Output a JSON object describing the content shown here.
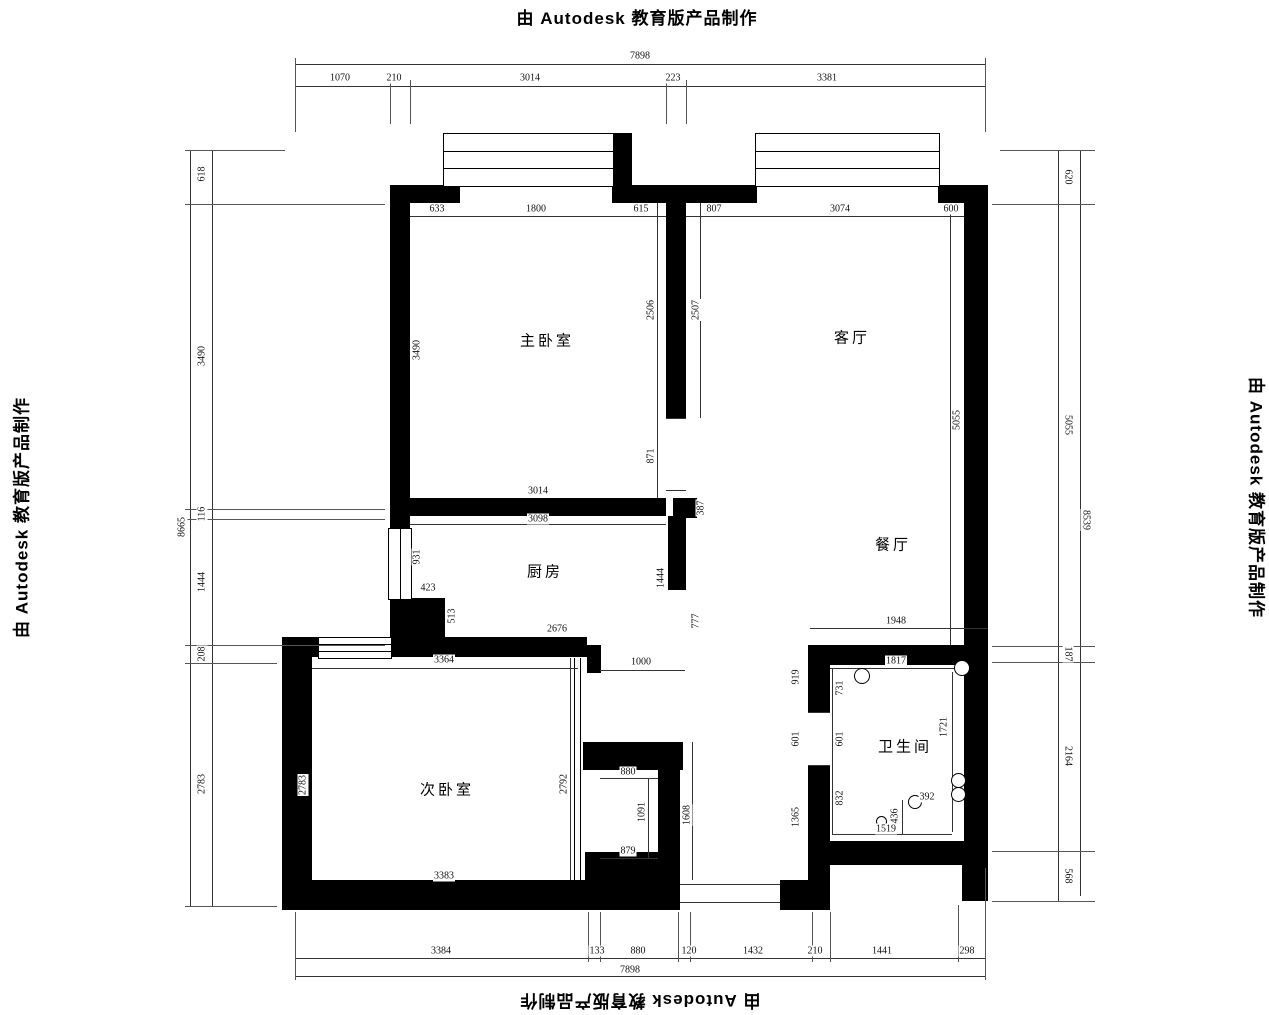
{
  "banner": "由 Autodesk 教育版产品制作",
  "rooms": {
    "master_bedroom": "主卧室",
    "living_room": "客厅",
    "kitchen": "厨房",
    "dining_room": "餐厅",
    "second_bedroom": "次卧室",
    "bathroom": "卫生间"
  },
  "dims": {
    "top": {
      "total": "7898",
      "segs": [
        "1070",
        "210",
        "3014",
        "223",
        "3381"
      ]
    },
    "bottom": {
      "total": "7898",
      "segs": [
        "3384",
        "133",
        "880",
        "120",
        "1432",
        "210",
        "1441",
        "298"
      ]
    },
    "left": {
      "total": "8665",
      "segs": [
        "618",
        "3490",
        "116",
        "1444",
        "208",
        "2783"
      ]
    },
    "right": {
      "total": "8539",
      "segs": [
        "620",
        "5055",
        "187",
        "2164",
        "568"
      ]
    },
    "interior": {
      "mb_top": [
        "633",
        "1800",
        "615"
      ],
      "lr_top": [
        "807",
        "3074",
        "600"
      ],
      "mb_left": "3490",
      "mb_door_right": "2506",
      "lr_wall_right": "2507",
      "mb_door": "871",
      "mb_bottom": "3014",
      "kitchen_top": "3098",
      "wall_seg": "387",
      "kitchen_win": "931",
      "step_a": "423",
      "step_b": "513",
      "kitchen_bottom": "2676",
      "kitchen_right": "1444",
      "kitchen_door": "777",
      "lr_height": "5055",
      "dining_bottom": "1948",
      "sb_top": "3364",
      "sb_left": "2783",
      "sb_right": "2792",
      "sb_bottom": "3383",
      "hall": "1000",
      "closet_top": "880",
      "closet_depth": "1091",
      "closet_right": "1608",
      "closet_bottom": "879",
      "bath_top": "1817",
      "bath_out_a": "919",
      "bath_in_a": "731",
      "bath_door_out": "601",
      "bath_door_in": "601",
      "bath_in_b": "832",
      "bath_out_b": "1365",
      "bath_right": "1721",
      "bath_bottom": "1519",
      "bath_step_v": "436",
      "bath_step_h": "392"
    }
  }
}
